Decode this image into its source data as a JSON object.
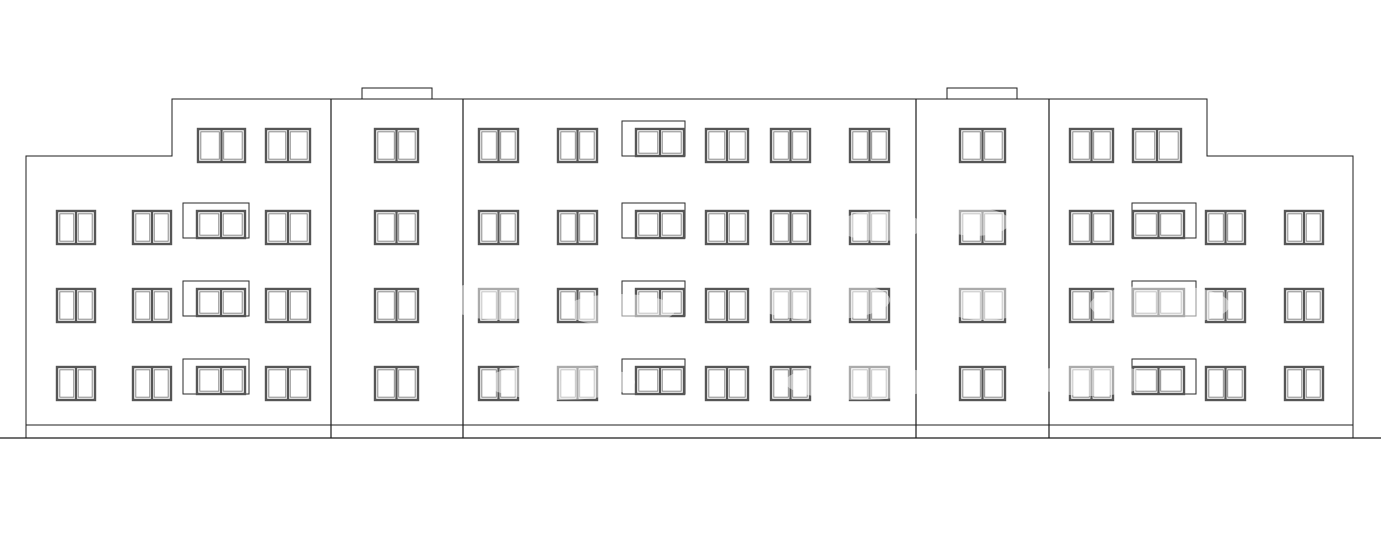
{
  "drawing": {
    "type": "architectural-front-elevation",
    "canvas": {
      "width": 1381,
      "height": 546,
      "background": "#ffffff"
    },
    "styles": {
      "outline_color": "#1c1c1c",
      "outline_width": 1,
      "divider_width": 1.2,
      "frame_color": "#565656",
      "frame_width": 2.4,
      "pane_color": "#7d7d7d",
      "pane_width": 0.9,
      "balcony_box_color": "#2a2a2a",
      "balcony_box_width": 1,
      "watermark_color": "#ffffff",
      "watermark_opacity": 0.5
    },
    "outline": {
      "points": [
        [
          26,
          438
        ],
        [
          26,
          156
        ],
        [
          172,
          156
        ],
        [
          172,
          99
        ],
        [
          1207,
          99
        ],
        [
          1207,
          156
        ],
        [
          1353,
          156
        ],
        [
          1353,
          438
        ]
      ]
    },
    "plinth_line": {
      "x1": 26,
      "x2": 1353,
      "y": 425
    },
    "ground_line": {
      "x1": 0,
      "x2": 1381,
      "y": 438
    },
    "roof_bumps": [
      {
        "x": 362,
        "y": 88,
        "w": 70,
        "h": 11
      },
      {
        "x": 947,
        "y": 88,
        "w": 70,
        "h": 11
      }
    ],
    "section_dividers": [
      {
        "x": 331,
        "y1": 99,
        "y2": 438
      },
      {
        "x": 463,
        "y1": 99,
        "y2": 438
      },
      {
        "x": 916,
        "y1": 99,
        "y2": 438
      },
      {
        "x": 1049,
        "y1": 99,
        "y2": 438
      }
    ],
    "window_defaults": {
      "height": 33,
      "balcony_window_height": 27,
      "balcony_box_rise": 8
    },
    "floors": [
      {
        "name": "floor-4",
        "y": 129,
        "windows": [
          {
            "x": 198,
            "w": 47
          },
          {
            "x": 266,
            "w": 44
          },
          {
            "x": 375,
            "w": 43
          },
          {
            "x": 479,
            "w": 39
          },
          {
            "x": 558,
            "w": 39
          },
          {
            "balcony": true,
            "box_x": 622,
            "box_w": 63,
            "x": 636,
            "w": 48
          },
          {
            "x": 706,
            "w": 42
          },
          {
            "x": 771,
            "w": 39
          },
          {
            "x": 850,
            "w": 39
          },
          {
            "x": 960,
            "w": 45
          },
          {
            "x": 1070,
            "w": 43
          },
          {
            "x": 1133,
            "w": 48
          }
        ]
      },
      {
        "name": "floor-3",
        "y": 211,
        "windows": [
          {
            "x": 57,
            "w": 38
          },
          {
            "x": 133,
            "w": 38
          },
          {
            "balcony": true,
            "box_x": 183,
            "box_w": 66,
            "x": 197,
            "w": 48
          },
          {
            "x": 266,
            "w": 44
          },
          {
            "x": 375,
            "w": 43
          },
          {
            "x": 479,
            "w": 39
          },
          {
            "x": 558,
            "w": 39
          },
          {
            "balcony": true,
            "box_x": 622,
            "box_w": 63,
            "x": 636,
            "w": 48
          },
          {
            "x": 706,
            "w": 42
          },
          {
            "x": 771,
            "w": 39
          },
          {
            "x": 850,
            "w": 39
          },
          {
            "x": 960,
            "w": 45
          },
          {
            "x": 1070,
            "w": 43
          },
          {
            "balcony": true,
            "box_x": 1132,
            "box_w": 64,
            "x": 1133,
            "w": 51
          },
          {
            "x": 1206,
            "w": 39
          },
          {
            "x": 1285,
            "w": 38
          }
        ]
      },
      {
        "name": "floor-2",
        "y": 289,
        "windows": [
          {
            "x": 57,
            "w": 38
          },
          {
            "x": 133,
            "w": 38
          },
          {
            "balcony": true,
            "box_x": 183,
            "box_w": 66,
            "x": 197,
            "w": 48
          },
          {
            "x": 266,
            "w": 44
          },
          {
            "x": 375,
            "w": 43
          },
          {
            "x": 479,
            "w": 39
          },
          {
            "x": 558,
            "w": 39
          },
          {
            "balcony": true,
            "box_x": 622,
            "box_w": 63,
            "x": 636,
            "w": 48
          },
          {
            "x": 706,
            "w": 42
          },
          {
            "x": 771,
            "w": 39
          },
          {
            "x": 850,
            "w": 39
          },
          {
            "x": 960,
            "w": 45
          },
          {
            "x": 1070,
            "w": 43
          },
          {
            "balcony": true,
            "box_x": 1132,
            "box_w": 64,
            "x": 1133,
            "w": 51
          },
          {
            "x": 1206,
            "w": 39
          },
          {
            "x": 1285,
            "w": 38
          }
        ]
      },
      {
        "name": "floor-1",
        "y": 367,
        "windows": [
          {
            "x": 57,
            "w": 38
          },
          {
            "x": 133,
            "w": 38
          },
          {
            "balcony": true,
            "box_x": 183,
            "box_w": 66,
            "x": 197,
            "w": 48
          },
          {
            "x": 266,
            "w": 44
          },
          {
            "x": 375,
            "w": 43
          },
          {
            "x": 479,
            "w": 39
          },
          {
            "x": 558,
            "w": 39
          },
          {
            "balcony": true,
            "box_x": 622,
            "box_w": 63,
            "x": 636,
            "w": 48
          },
          {
            "x": 706,
            "w": 42
          },
          {
            "x": 771,
            "w": 39
          },
          {
            "x": 850,
            "w": 39
          },
          {
            "x": 960,
            "w": 45
          },
          {
            "x": 1070,
            "w": 43
          },
          {
            "balcony": true,
            "box_x": 1132,
            "box_w": 64,
            "x": 1133,
            "w": 51
          },
          {
            "x": 1206,
            "w": 39
          },
          {
            "x": 1285,
            "w": 38
          }
        ]
      }
    ],
    "watermark_blobs": [
      {
        "cx": 500,
        "cy": 300,
        "rx": 55,
        "ry": 20
      },
      {
        "cx": 620,
        "cy": 310,
        "rx": 55,
        "ry": 16
      },
      {
        "cx": 820,
        "cy": 300,
        "rx": 70,
        "ry": 20
      },
      {
        "cx": 985,
        "cy": 300,
        "rx": 50,
        "ry": 20
      },
      {
        "cx": 1160,
        "cy": 305,
        "rx": 70,
        "ry": 20
      },
      {
        "cx": 560,
        "cy": 382,
        "rx": 75,
        "ry": 18
      },
      {
        "cx": 860,
        "cy": 382,
        "rx": 75,
        "ry": 18
      },
      {
        "cx": 1090,
        "cy": 380,
        "rx": 60,
        "ry": 16
      },
      {
        "cx": 880,
        "cy": 226,
        "rx": 42,
        "ry": 15
      },
      {
        "cx": 975,
        "cy": 222,
        "rx": 35,
        "ry": 14
      }
    ]
  }
}
